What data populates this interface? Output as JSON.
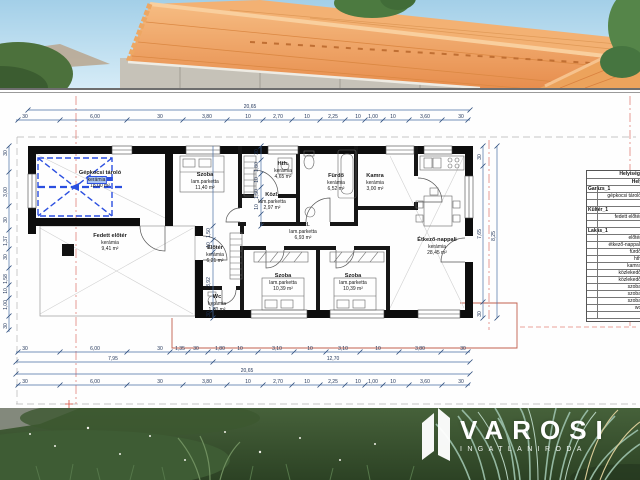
{
  "plan": {
    "rooms": [
      {
        "name": "Gépkocsi tároló",
        "floor": "kerámia",
        "area": "18,00 m²"
      },
      {
        "name": "Fedett előtér",
        "floor": "kerámia",
        "area": "9,41 m²"
      },
      {
        "name": "Szoba",
        "floor": "lam.parketta",
        "area": "11,40 m²"
      },
      {
        "name": "Hth.",
        "floor": "kerámia",
        "area": "4,65 m²"
      },
      {
        "name": "Közl.",
        "floor": "lam.parketta",
        "area": "2,97 m²"
      },
      {
        "name": "Fürdő",
        "floor": "kerámia",
        "area": "6,52 m²"
      },
      {
        "name": "Kamra",
        "floor": "kerámia",
        "area": "3,00 m²"
      },
      {
        "name": "Közl.",
        "floor": "lam.parketta",
        "area": "6,93 m²"
      },
      {
        "name": "Étkező-nappali",
        "floor": "kerámia",
        "area": "28,45 m²"
      },
      {
        "name": "Előtér",
        "floor": "kerámia",
        "area": "6,21 m²"
      },
      {
        "name": "Wc",
        "floor": "kerámia",
        "area": "1,60 m²"
      },
      {
        "name": "Szoba",
        "floor": "lam.parketta",
        "area": "10,39 m²"
      },
      {
        "name": "Szoba",
        "floor": "lam.parketta",
        "area": "10,39 m²"
      }
    ],
    "dims": {
      "top_total": "20,65",
      "top_chain": [
        "30",
        "6,00",
        "30",
        "3,80",
        "10",
        "2,70",
        "10",
        "2,25",
        "10",
        "1,00",
        "10",
        "3,60",
        "30"
      ],
      "bottom_chain_detail": [
        "30",
        "6,00",
        "30",
        "1,35",
        "30",
        "1,80",
        "10",
        "3,10",
        "10",
        "3,10",
        "10",
        "3,80",
        "30"
      ],
      "bottom_spans": [
        "7,95",
        "12,70"
      ],
      "bottom_total": "20,65",
      "bottom_chain_outer": [
        "30",
        "6,00",
        "30",
        "3,80",
        "10",
        "2,70",
        "10",
        "2,25",
        "10",
        "1,00",
        "10",
        "3,60",
        "30"
      ],
      "left_chain": [
        "30",
        "3,00",
        "30",
        "1,37",
        "30",
        "1,58",
        "10",
        "1,00",
        "30"
      ],
      "right_chain": [
        "30",
        "7,65",
        "30"
      ],
      "right_total": "8,25",
      "inner_chain_a": [
        "30",
        "1,80",
        "10",
        "1,50",
        "10"
      ],
      "inner_chain_b": [
        "1,50",
        "10",
        "3,92",
        "30"
      ]
    },
    "schedule": {
      "title": "Helyiség kimutatás",
      "column": "Helyiség",
      "rows": [
        "Garázs_1",
        "gépkocsi tároló",
        "",
        "Kültér_1",
        "fedett előtér",
        "",
        "Lakás_1",
        "előtér",
        "étkező-nappali",
        "fürdő",
        "hth",
        "kamra",
        "közlekedő",
        "közlekedő",
        "szoba",
        "szoba",
        "szoba",
        "wc",
        ""
      ]
    }
  },
  "logo": {
    "brand": "VAROSI",
    "tagline": "INGATLANIRODA"
  }
}
